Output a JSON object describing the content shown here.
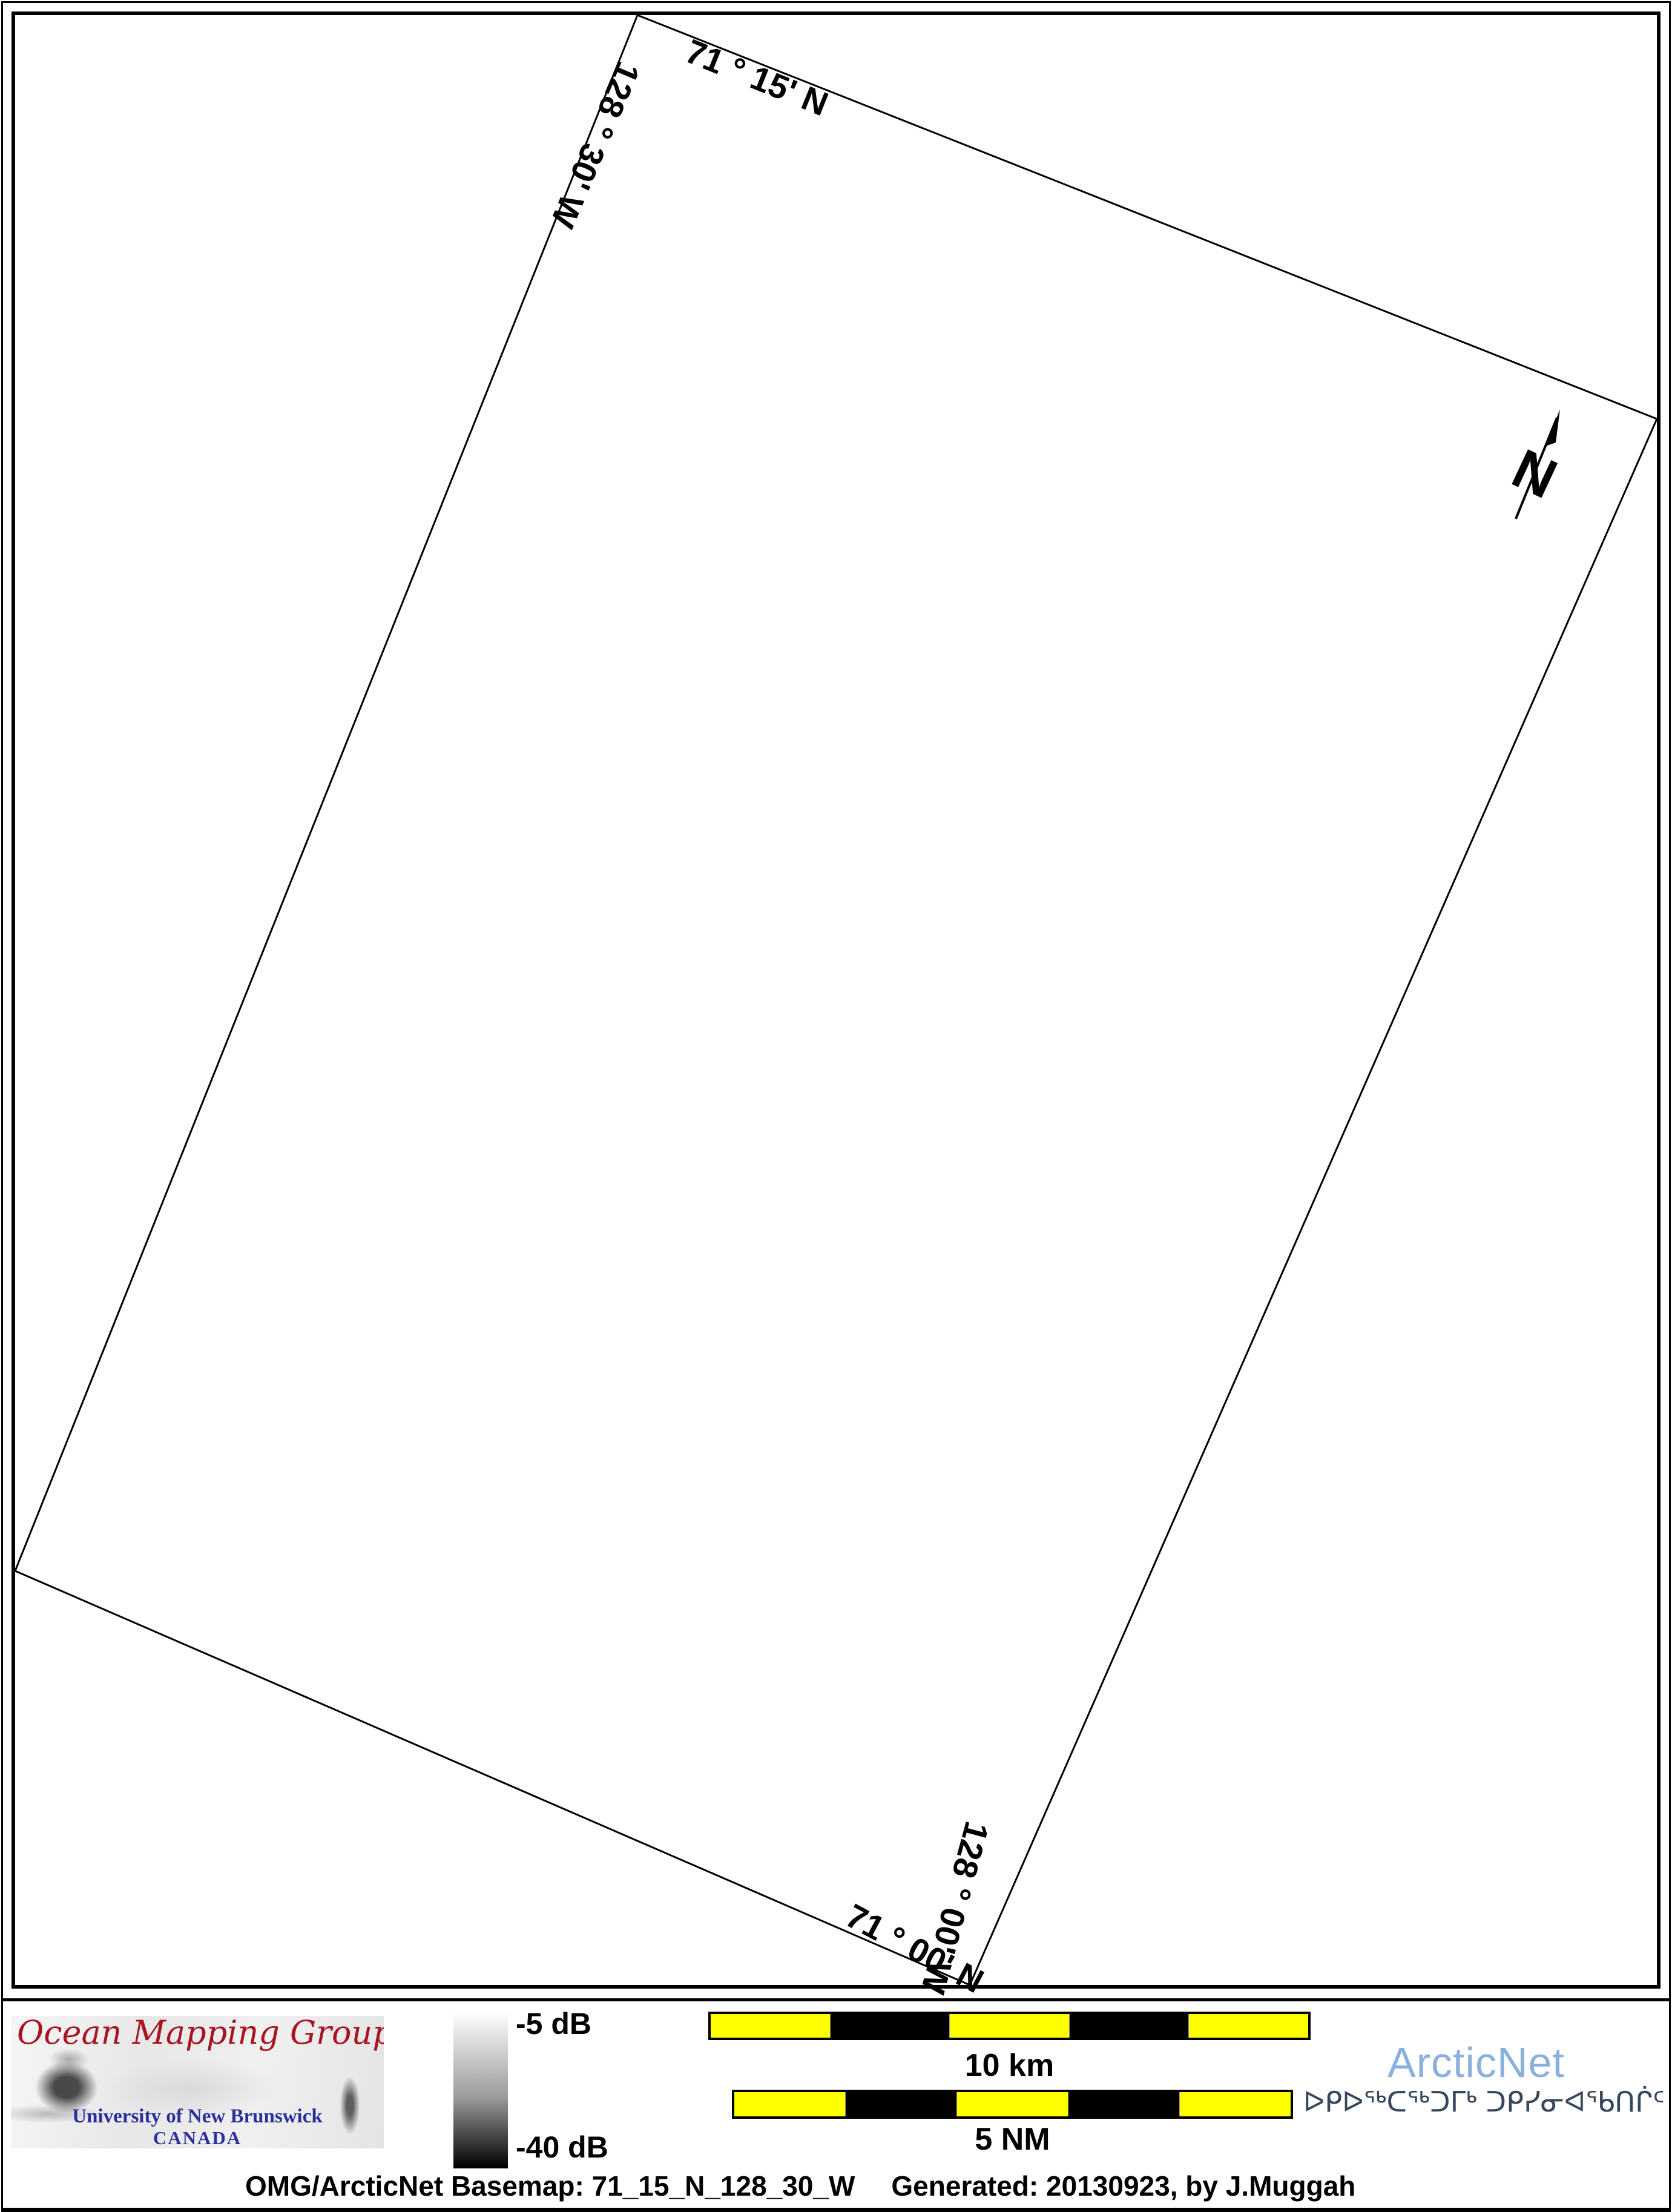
{
  "map": {
    "corner_labels": {
      "top_lat": "71 ° 15' N",
      "left_lon": "128 ° 30' W",
      "bottom_lat": "71 ° 00' N",
      "right_lon": "128 ° 00' W"
    },
    "north_label": "N"
  },
  "legend": {
    "logo": {
      "title": "Ocean Mapping Group",
      "title_color": "#a81421",
      "subtitle": "University of New Brunswick",
      "country": "CANADA",
      "subtitle_color": "#2b2f9e"
    },
    "colorbar": {
      "top_label": "-5 dB",
      "bottom_label": "-40 dB",
      "top_color": "#ffffff",
      "bottom_color": "#000000"
    },
    "scale_bar_yellow": "#ffff00",
    "scale_bar_black": "#000000",
    "scalebars": [
      {
        "label": "10 km",
        "segments": [
          "yellow",
          "black",
          "yellow",
          "black",
          "yellow"
        ]
      },
      {
        "label": "5 NM",
        "segments": [
          "yellow",
          "black",
          "yellow",
          "black",
          "yellow"
        ]
      }
    ],
    "arcticnet": {
      "name": "ArcticNet",
      "color": "#8ab0de",
      "inuktitut": "ᐅᑭᐅᖅᑕᖅᑐᒥᒃ ᑐᑭᓯᓂᐊᖃᑎᒌᑦ",
      "inuktitut_color": "#36465c"
    },
    "caption": {
      "left": "OMG/ArcticNet Basemap: 71_15_N_128_30_W",
      "right": "Generated: 20130923, by J.Muggah"
    }
  }
}
